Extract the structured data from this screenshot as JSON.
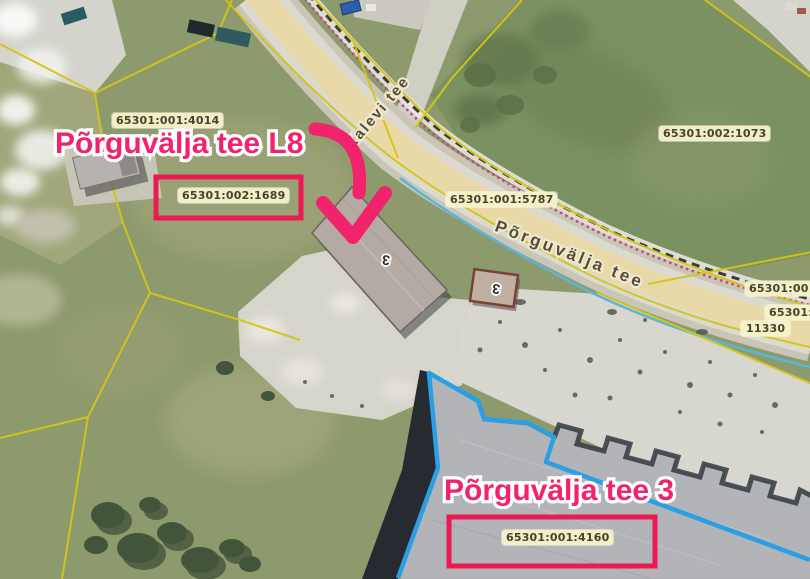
{
  "map": {
    "type": "aerial-cadastral-map",
    "annotations": {
      "target_parcel": "Põrguvälja tee L8",
      "neighbor_parcel": "Põrguvälja tee 3"
    },
    "roads": {
      "main_road_name": "Põrguvälja tee",
      "side_road_name": "Kalevi tee",
      "road_number": "11330"
    },
    "parcel_labels": {
      "p4014": "65301:001:4014",
      "p1689": "65301:002:1689",
      "p1073": "65301:002:1073",
      "p5787": "65301:001:5787",
      "p4160": "65301:001:4160",
      "edge_cut_top": "65301:00",
      "edge_cut_bottom": "65301:1"
    },
    "building_markers": {
      "main_building": "3",
      "small_building": "3"
    },
    "colors": {
      "annotation_pink": "#f2236d",
      "highlight_box_red": "#ea1a52",
      "cadastral_line_yellow": "#d3c516",
      "parcel_outline_blue": "#2b9fe3",
      "utility_line_cyan": "#5ab6d6",
      "label_background": "#f6f2c8",
      "road_fill_beige": "#ead9a8"
    }
  }
}
